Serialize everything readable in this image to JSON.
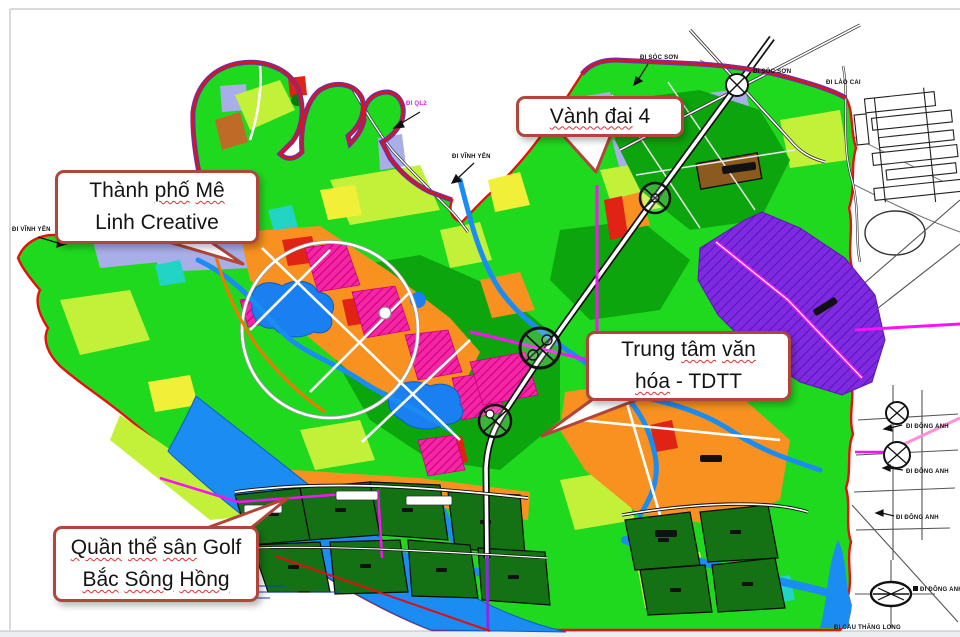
{
  "page": {
    "background": "#ffffff"
  },
  "callouts": {
    "ring_road": {
      "seg_wavy": "Vành đai",
      "seg_plain": "4"
    },
    "me_linh": {
      "l1_plain": "Thành",
      "l1_wavy1": "phố",
      "l1_wavy2": "Mê",
      "l2": "Linh Creative"
    },
    "culture": {
      "l1_plain": "Trung",
      "l1_wavy1": "tâm",
      "l1_wavy2": "văn",
      "l2_wavy": "hóa",
      "l2_plain": "- TDTT"
    },
    "golf": {
      "l1_wavy1": "Quần",
      "l1_wavy2": "thể",
      "l1_wavy3": "sân",
      "l1_plain": "Golf",
      "l2_wavy1": "Bắc",
      "l2_wavy2": "Sông",
      "l2_wavy3": "Hồng"
    }
  },
  "map": {
    "road_labels": {
      "soc_son": "ĐI SÓC SƠN",
      "lao_cai": "ĐI LÀO CAI",
      "ql2": "ĐI QL2",
      "vinh_yen": "ĐI VĨNH YÊN",
      "dong_anh": "ĐI ĐÔNG ANH",
      "cau_thang_long": "ĐI CẦU THĂNG LONG"
    },
    "colors": {
      "residential_green": "#1fd91f",
      "light_green": "#c3f13a",
      "park_dark_green": "#0da50d",
      "golf_green": "#147214",
      "orange_urban": "#f8911f",
      "red_block": "#e02315",
      "pink_mixed_use": "#f525a5",
      "purple_industrial": "#7d2ae0",
      "water_blue": "#1b8cf2",
      "lavender": "#a8aee8",
      "magenta_road": "#f614f6",
      "boundary_red": "#e8100c",
      "boundary_purple": "#7030a0",
      "callout_border": "#b2453a"
    }
  }
}
